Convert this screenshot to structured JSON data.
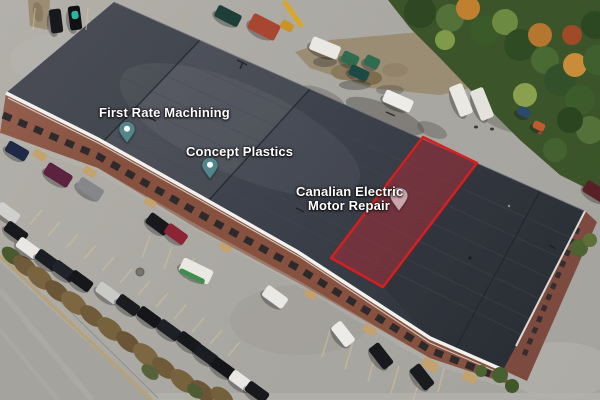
{
  "map": {
    "view": "satellite-aerial",
    "labels": [
      {
        "id": "first-rate-machining",
        "text": "First Rate Machining",
        "pin": "teal"
      },
      {
        "id": "concept-plastics",
        "text": "Concept Plastics",
        "pin": "teal"
      },
      {
        "id": "canalian-electric-motor-repair",
        "line1": "Canalian Electric",
        "line2": "Motor Repair",
        "pin": "pink"
      }
    ],
    "highlight": {
      "name": "highlighted-unit",
      "fill": "rgba(193,42,52,0.42)",
      "stroke": "#d61f1f"
    },
    "pins": {
      "teal": "#54858b",
      "teal_dot": "#fdfdfd",
      "pink": "#c8a6ab",
      "pink_dot": "#cf8590"
    },
    "label_color": "#ffffff"
  },
  "scene": {
    "ground_color": "#adaaa4",
    "roof_color": "#3d4149",
    "brick_color": "#8a5547",
    "vehicles": [
      {
        "x": 56,
        "y": 21,
        "l": 24,
        "w": 12,
        "r": 83,
        "c": "#17191d"
      },
      {
        "x": 75,
        "y": 18,
        "l": 24,
        "w": 12,
        "r": 83,
        "c": "#0f1114"
      },
      {
        "x": 75,
        "y": 15,
        "l": 8,
        "w": 7,
        "r": 83,
        "c": "#2ab5a0",
        "s": 0
      },
      {
        "x": 228,
        "y": 16,
        "l": 26,
        "w": 13,
        "r": 27,
        "c": "#1e3f38"
      },
      {
        "x": 264,
        "y": 27,
        "l": 30,
        "w": 17,
        "r": 27,
        "c": "#a84632"
      },
      {
        "x": 293,
        "y": 14,
        "l": 32,
        "w": 5,
        "r": 55,
        "c": "#d9a62c",
        "s": 0
      },
      {
        "x": 287,
        "y": 26,
        "l": 13,
        "w": 9,
        "r": 30,
        "c": "#c89428",
        "s": 0
      },
      {
        "x": 325,
        "y": 48,
        "l": 30,
        "w": 14,
        "r": 22,
        "c": "#e9e8e3"
      },
      {
        "x": 350,
        "y": 59,
        "l": 17,
        "w": 12,
        "r": 25,
        "c": "#2e6b4f"
      },
      {
        "x": 372,
        "y": 62,
        "l": 15,
        "w": 11,
        "r": 25,
        "c": "#2e6b4f"
      },
      {
        "x": 359,
        "y": 73,
        "l": 20,
        "w": 11,
        "r": 25,
        "c": "#1d4a44"
      },
      {
        "x": 398,
        "y": 101,
        "l": 30,
        "w": 13,
        "r": 24,
        "c": "#edece8"
      },
      {
        "x": 461,
        "y": 100,
        "l": 32,
        "w": 14,
        "r": 68,
        "c": "#eae8e2"
      },
      {
        "x": 482,
        "y": 104,
        "l": 32,
        "w": 14,
        "r": 68,
        "c": "#e4e2dc"
      },
      {
        "x": 524,
        "y": 112,
        "l": 13,
        "w": 9,
        "r": 25,
        "c": "#2a4a6b"
      },
      {
        "x": 539,
        "y": 126,
        "l": 12,
        "w": 8,
        "r": 25,
        "c": "#c05a30"
      },
      {
        "x": 476,
        "y": 127,
        "l": 4,
        "w": 3,
        "r": 0,
        "c": "#3a3a3a",
        "s": 0
      },
      {
        "x": 492,
        "y": 129,
        "l": 4,
        "w": 3,
        "r": 0,
        "c": "#3a3a3a",
        "s": 0
      },
      {
        "x": 540,
        "y": 133,
        "l": 4,
        "w": 3,
        "r": 0,
        "c": "#a33c36",
        "s": 0
      },
      {
        "x": 596,
        "y": 192,
        "l": 26,
        "w": 13,
        "r": 32,
        "c": "#5a2027"
      },
      {
        "x": 17,
        "y": 151,
        "l": 23,
        "w": 12,
        "r": 30,
        "c": "#1f2a47"
      },
      {
        "x": 58,
        "y": 175,
        "l": 28,
        "w": 14,
        "r": 32,
        "c": "#5c2340"
      },
      {
        "x": 90,
        "y": 189,
        "l": 27,
        "w": 13,
        "r": 32,
        "c": "#85878a"
      },
      {
        "x": 158,
        "y": 224,
        "l": 24,
        "w": 13,
        "r": 36,
        "c": "#17191d"
      },
      {
        "x": 176,
        "y": 234,
        "l": 23,
        "w": 12,
        "r": 36,
        "c": "#8c2433"
      },
      {
        "x": 196,
        "y": 271,
        "l": 33,
        "w": 15,
        "r": 26,
        "c": "#e9e8e2"
      },
      {
        "x": 192,
        "y": 276,
        "l": 28,
        "w": 5,
        "r": 26,
        "c": "#3f8f4f",
        "s": 0
      },
      {
        "x": 275,
        "y": 297,
        "l": 25,
        "w": 13,
        "r": 36,
        "c": "#e9e8e4"
      },
      {
        "x": 8,
        "y": 213,
        "l": 24,
        "w": 12,
        "r": 36,
        "c": "#cfd0cc"
      },
      {
        "x": 16,
        "y": 232,
        "l": 24,
        "w": 12,
        "r": 36,
        "c": "#17191d"
      },
      {
        "x": 28,
        "y": 248,
        "l": 24,
        "w": 12,
        "r": 36,
        "c": "#e8e7e3"
      },
      {
        "x": 47,
        "y": 260,
        "l": 24,
        "w": 12,
        "r": 36,
        "c": "#1a1d22"
      },
      {
        "x": 64,
        "y": 271,
        "l": 24,
        "w": 12,
        "r": 36,
        "c": "#202329"
      },
      {
        "x": 81,
        "y": 281,
        "l": 24,
        "w": 12,
        "r": 36,
        "c": "#15171b"
      },
      {
        "x": 108,
        "y": 293,
        "l": 25,
        "w": 12,
        "r": 36,
        "c": "#c9cac6"
      },
      {
        "x": 128,
        "y": 305,
        "l": 24,
        "w": 12,
        "r": 36,
        "c": "#1a1c20"
      },
      {
        "x": 149,
        "y": 317,
        "l": 24,
        "w": 12,
        "r": 36,
        "c": "#14161a"
      },
      {
        "x": 169,
        "y": 330,
        "l": 24,
        "w": 12,
        "r": 36,
        "c": "#1d2025"
      },
      {
        "x": 189,
        "y": 342,
        "l": 24,
        "w": 12,
        "r": 36,
        "c": "#16181c"
      },
      {
        "x": 206,
        "y": 355,
        "l": 24,
        "w": 12,
        "r": 36,
        "c": "#1a1d21"
      },
      {
        "x": 223,
        "y": 368,
        "l": 24,
        "w": 12,
        "r": 36,
        "c": "#131518"
      },
      {
        "x": 241,
        "y": 381,
        "l": 24,
        "w": 12,
        "r": 36,
        "c": "#e8e7e3"
      },
      {
        "x": 257,
        "y": 392,
        "l": 24,
        "w": 12,
        "r": 36,
        "c": "#17191d"
      },
      {
        "x": 343,
        "y": 334,
        "l": 25,
        "w": 13,
        "r": 52,
        "c": "#ecebe7"
      },
      {
        "x": 381,
        "y": 356,
        "l": 26,
        "w": 13,
        "r": 52,
        "c": "#17191d"
      },
      {
        "x": 422,
        "y": 377,
        "l": 26,
        "w": 13,
        "r": 52,
        "c": "#191b1f"
      }
    ]
  }
}
